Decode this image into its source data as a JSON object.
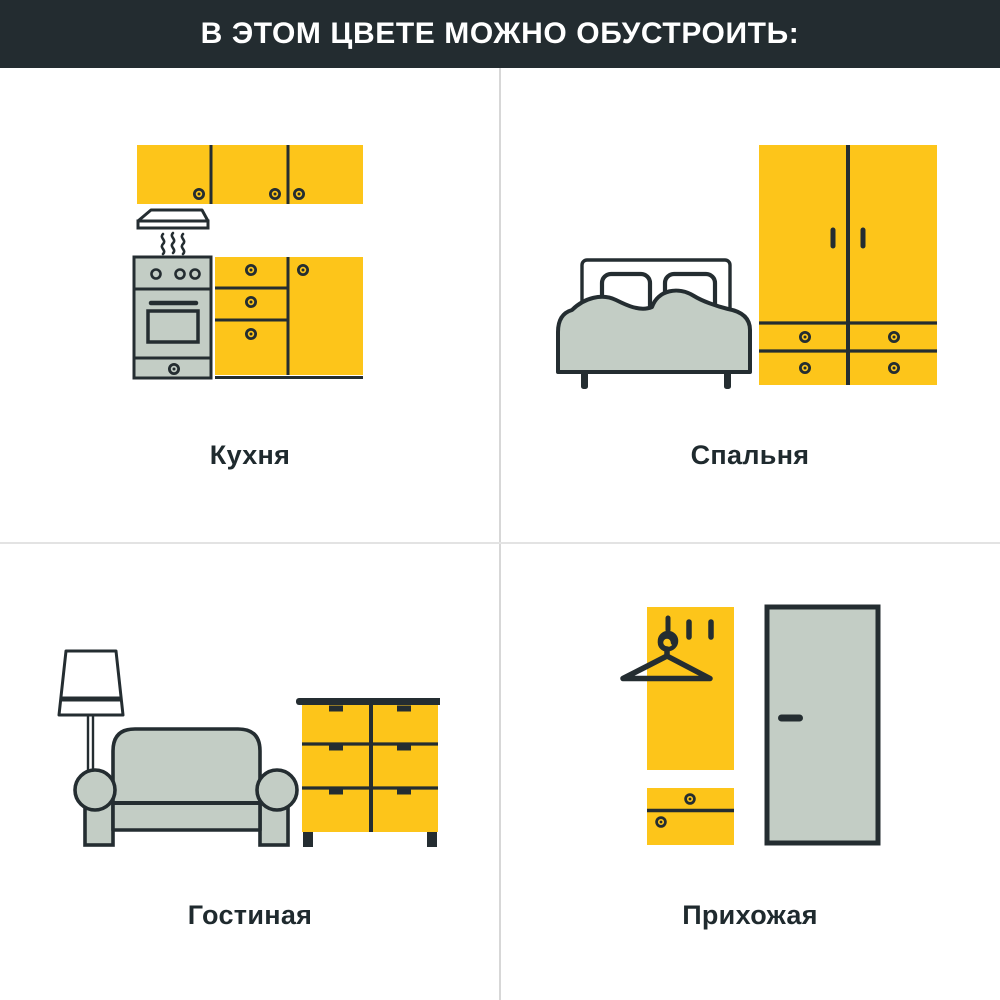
{
  "colors": {
    "yellow": "#FDC51A",
    "sage": "#C3CDC5",
    "ink": "#242D31",
    "header-bg": "#232C30",
    "header-text": "#FFFFFF",
    "label": "#1F2A2E",
    "divider-v": "#D7D7D7",
    "divider-h": "#E3E3E3",
    "bg": "#FFFFFF"
  },
  "header": {
    "title": "В ЭТОМ ЦВЕТЕ МОЖНО ОБУСТРОИТЬ:"
  },
  "sections": [
    {
      "id": "kitchen",
      "label": "Кухня",
      "illustration": "kitchen-icon"
    },
    {
      "id": "bedroom",
      "label": "Спальня",
      "illustration": "bedroom-icon"
    },
    {
      "id": "living-room",
      "label": "Гостиная",
      "illustration": "living-room-icon"
    },
    {
      "id": "hallway",
      "label": "Прихожая",
      "illustration": "hallway-icon"
    }
  ]
}
